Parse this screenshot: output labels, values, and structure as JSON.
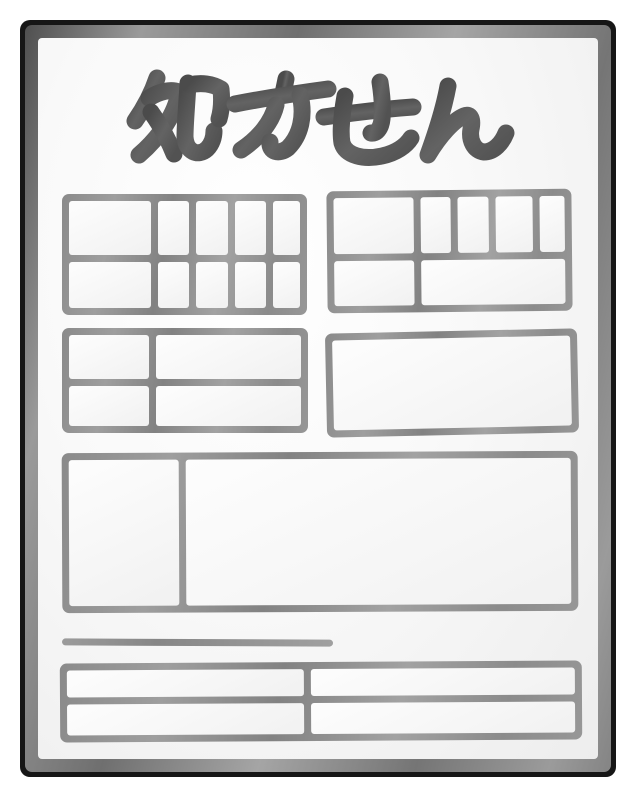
{
  "title": {
    "text": "処方せん"
  },
  "colors": {
    "background": "#ffffff",
    "paper": "#f9f9f9",
    "paper_edge_gray": "#8a8a8a",
    "paper_outline_black": "#161616",
    "title_ink": "#565656",
    "table_line": "#909090"
  },
  "sections": {
    "top_left_table": {
      "rows": 2,
      "cols": 5,
      "note": "wide first column, 4 narrow columns, all spanning both rows"
    },
    "top_right_table": {
      "rows": 2,
      "cols": 5,
      "note": "wide first column + 4 narrow columns in row 1; row 2 has one wide merged cell"
    },
    "middle_left_table": {
      "rows": 2,
      "cols": 2
    },
    "middle_right_box": {
      "rows": 1,
      "cols": 1
    },
    "center_large_box": {
      "rows": 1,
      "cols": 2
    },
    "separator_line": {
      "count": 1
    },
    "bottom_table": {
      "rows": 2,
      "cols": 2
    }
  }
}
